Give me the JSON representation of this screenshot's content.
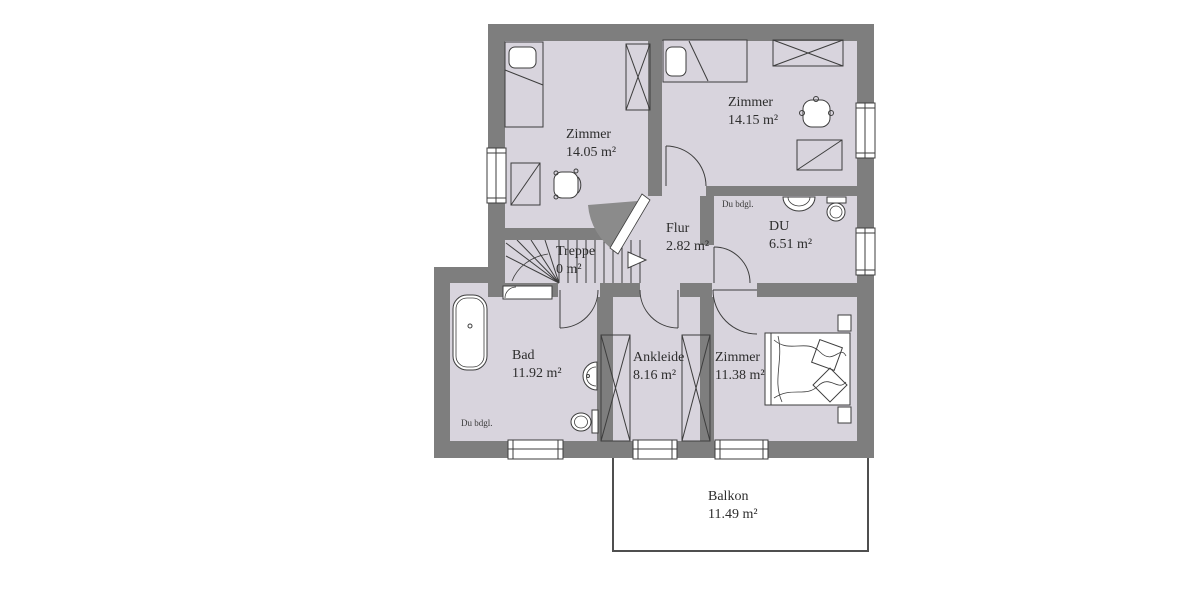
{
  "colors": {
    "wall": "#7e7e7e",
    "room_fill": "#d8d4dd",
    "line": "#3d3d3d",
    "door_swing_shade": "#8b8b8b",
    "balcony_border": "#4f4f4f",
    "text": "#2d2d2d",
    "background": "#ffffff"
  },
  "rooms": [
    {
      "id": "zimmer_tl",
      "name": "Zimmer",
      "area": "14.05 m²"
    },
    {
      "id": "zimmer_tr",
      "name": "Zimmer",
      "area": "14.15 m²"
    },
    {
      "id": "flur",
      "name": "Flur",
      "area": "2.82 m²"
    },
    {
      "id": "du",
      "name": "DU",
      "area": "6.51 m²",
      "note": "Du bdgl."
    },
    {
      "id": "treppe",
      "name": "Treppe",
      "area": "0 m²"
    },
    {
      "id": "bad",
      "name": "Bad",
      "area": "11.92 m²",
      "note": "Du bdgl."
    },
    {
      "id": "ankleide",
      "name": "Ankleide",
      "area": "8.16 m²"
    },
    {
      "id": "zimmer_br",
      "name": "Zimmer",
      "area": "11.38 m²"
    },
    {
      "id": "balkon",
      "name": "Balkon",
      "area": "11.49 m²"
    }
  ]
}
